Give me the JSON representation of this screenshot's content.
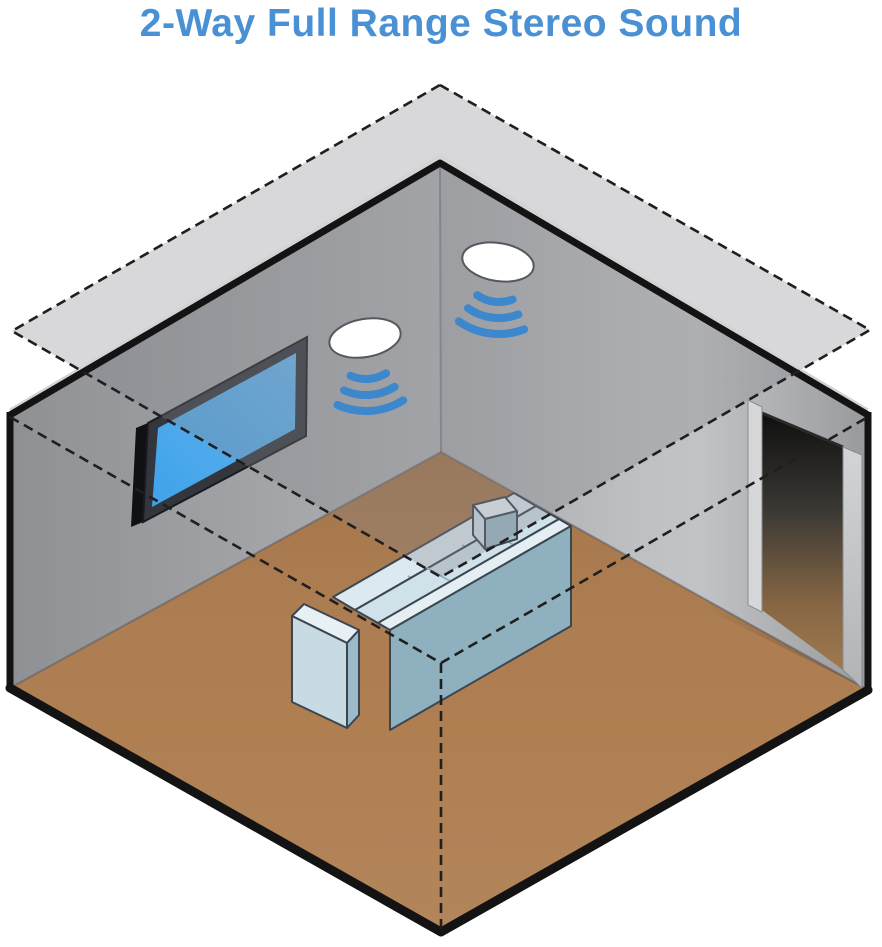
{
  "title": {
    "text": "2-Way Full Range Stereo Sound",
    "color": "#4a90d4"
  },
  "colors": {
    "background": "#ffffff",
    "dash_black": "#1f1f1f",
    "outline_black": "#131313",
    "plane_gray_fill": "#85878d",
    "plane_over_white": "#d8d9db",
    "floor_brown": "#ad7c4e",
    "wall_gray_left": "#9b9da0",
    "wall_gray_right": "#c0c2c5",
    "tv_frame_dark": "#33373d",
    "tv_screen_blue": "#41a3ea",
    "wave_blue": "#3d87cd",
    "speaker_white": "#ffffff",
    "couch_teal": "#8fb1bf",
    "couch_light": "#dce9f0",
    "doorway_dark": "#151515"
  }
}
